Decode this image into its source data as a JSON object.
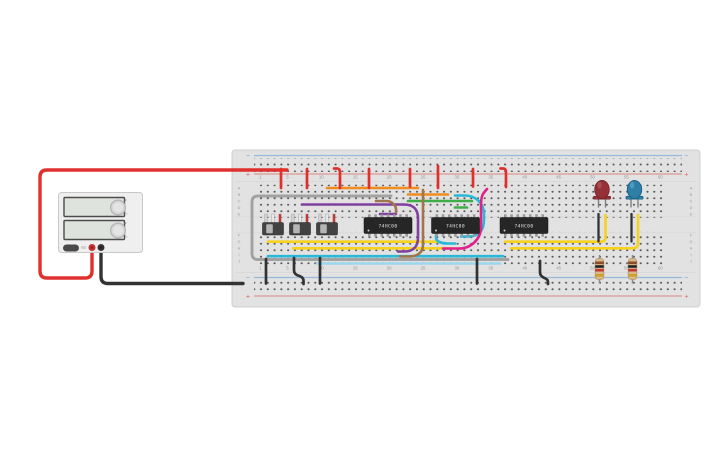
{
  "canvas": {
    "bg": "#ffffff"
  },
  "board": {
    "x": 232,
    "y": 150,
    "w": 468,
    "h": 157,
    "fill": "#e2e2e2",
    "edge": "#cfcfcf",
    "hole": "#575757",
    "column_labels": [
      "1",
      "5",
      "10",
      "15",
      "20",
      "25",
      "30",
      "35",
      "40",
      "45",
      "50",
      "55",
      "60"
    ],
    "column_numbers": [
      1,
      5,
      10,
      15,
      20,
      25,
      30,
      35,
      40,
      45,
      50,
      55,
      60
    ],
    "row_letters": [
      "A",
      "B",
      "C",
      "D",
      "E",
      "F",
      "G",
      "H",
      "I",
      "J"
    ],
    "rails": {
      "minus": "−",
      "plus": "+",
      "blue": "#5b9bd5",
      "red": "#e05a5a"
    }
  },
  "psu": {
    "x": 58.5,
    "y": 192.5,
    "w": 84,
    "h": 60,
    "body": "#efefef",
    "edge": "#c8c8c8",
    "display_fill": "#dfe3dd",
    "display_edge": "#4c4c4c",
    "knob_fill": "#d7d7d7",
    "knob_edge": "#b3b3b3",
    "button_fill": "#4a4a4a",
    "terminals": [
      {
        "name": "positive-terminal",
        "cx": 92,
        "cy": 247.5,
        "color": "#d32f2f"
      },
      {
        "name": "negative-terminal",
        "cx": 101,
        "cy": 247.5,
        "color": "#333333"
      }
    ]
  },
  "chips": [
    {
      "label": "74HC00",
      "x": 364,
      "y": 217.5,
      "w": 48,
      "h": 16
    },
    {
      "label": "74HC00",
      "x": 431.5,
      "y": 217.5,
      "w": 48,
      "h": 16
    },
    {
      "label": "74HC00",
      "x": 500,
      "y": 217.5,
      "w": 48,
      "h": 16
    }
  ],
  "switches": [
    {
      "cx": 273
    },
    {
      "cx": 300
    },
    {
      "cx": 327
    }
  ],
  "leds": [
    {
      "name": "led-red",
      "cx": 602,
      "body": "#973138",
      "dark": "#6f2228",
      "light": "#b2555c"
    },
    {
      "name": "led-blue",
      "cx": 634.5,
      "body": "#2d7fa7",
      "dark": "#1f5f80",
      "light": "#5ba4c4"
    }
  ],
  "resistors": [
    {
      "cx": 599.5,
      "bands": [
        "#8a4b2a",
        "#242424",
        "#c03a3a",
        "#c9a227"
      ]
    },
    {
      "cx": 632.5,
      "bands": [
        "#8a4b2a",
        "#242424",
        "#c03a3a",
        "#c9a227"
      ]
    }
  ],
  "wires": [
    {
      "name": "cyan-bus-row-i",
      "color": "#29b8d8",
      "w": 2.6,
      "r": 5,
      "pts": [
        [
          268,
          256.2
        ],
        [
          503,
          256.2
        ]
      ]
    },
    {
      "name": "lightblue-bus-row-j",
      "color": "#9bd7ee",
      "w": 2.6,
      "r": 5,
      "pts": [
        [
          317,
          263.5
        ],
        [
          500,
          263.5
        ]
      ]
    },
    {
      "name": "gray-bus-wire",
      "color": "#a2a2a2",
      "w": 2.9,
      "r": 6,
      "pts": [
        [
          391,
          196
        ],
        [
          252,
          196
        ],
        [
          252,
          259.5
        ],
        [
          508,
          259.5
        ]
      ]
    },
    {
      "name": "yellow-wire-g-left",
      "color": "#f7d21c",
      "w": 2.6,
      "r": 5,
      "pts": [
        [
          268,
          241.7
        ],
        [
          437,
          241.7
        ]
      ]
    },
    {
      "name": "yellow-wire-h-left",
      "color": "#f7d21c",
      "w": 2.6,
      "r": 5,
      "pts": [
        [
          293,
          248.3
        ],
        [
          452,
          248.3
        ]
      ]
    },
    {
      "name": "yellow-wire-g-right",
      "color": "#f7d21c",
      "w": 2.6,
      "r": 5,
      "pts": [
        [
          505,
          241.7
        ],
        [
          605.5,
          241.7
        ],
        [
          605.5,
          215
        ]
      ]
    },
    {
      "name": "yellow-wire-h-right",
      "color": "#f7d21c",
      "w": 2.6,
      "r": 5,
      "pts": [
        [
          511,
          248.3
        ],
        [
          638,
          248.3
        ],
        [
          638,
          215
        ]
      ]
    },
    {
      "name": "orange-wire-row-a",
      "color": "#f08c1d",
      "w": 2.6,
      "r": 5,
      "pts": [
        [
          327,
          188
        ],
        [
          418,
          188
        ]
      ]
    },
    {
      "name": "orange-wire-row-b",
      "color": "#f08c1d",
      "w": 2.6,
      "r": 5,
      "pts": [
        [
          408,
          194.5
        ],
        [
          448,
          194.5
        ]
      ]
    },
    {
      "name": "green-wire-row-c",
      "color": "#3fae49",
      "w": 2.6,
      "r": 5,
      "pts": [
        [
          408,
          201
        ],
        [
          472,
          201
        ]
      ]
    },
    {
      "name": "green-wire-row-d",
      "color": "#3fae49",
      "w": 2.6,
      "r": 5,
      "pts": [
        [
          455,
          207.5
        ],
        [
          467,
          207.5
        ]
      ]
    },
    {
      "name": "purple-wire-loop",
      "color": "#8040a0",
      "w": 2.6,
      "r": 7,
      "pts": [
        [
          302,
          204.5
        ],
        [
          411,
          204.5
        ],
        [
          418,
          211.5
        ],
        [
          418,
          244.5
        ],
        [
          411,
          251.5
        ],
        [
          398,
          251.5
        ]
      ]
    },
    {
      "name": "purple-wire-stub",
      "color": "#8040a0",
      "w": 2.6,
      "r": 4,
      "pts": [
        [
          380,
          214
        ],
        [
          396,
          214
        ]
      ]
    },
    {
      "name": "brown-wire-vertical",
      "color": "#a0744c",
      "w": 2.6,
      "r": 6,
      "pts": [
        [
          423,
          190
        ],
        [
          423,
          250.5
        ],
        [
          415.5,
          256.5
        ],
        [
          400,
          256.5
        ]
      ]
    },
    {
      "name": "brown-wire-stub",
      "color": "#a0744c",
      "w": 2.6,
      "r": 4,
      "pts": [
        [
          376,
          201
        ],
        [
          390.5,
          201
        ],
        [
          396,
          206.5
        ],
        [
          396,
          212
        ]
      ]
    },
    {
      "name": "cyan-hook-chip2",
      "color": "#29b8d8",
      "w": 2.6,
      "r": 5,
      "pts": [
        [
          436,
          235
        ],
        [
          436,
          240.5
        ],
        [
          443,
          243.5
        ],
        [
          455,
          243.5
        ]
      ]
    },
    {
      "name": "cyan-loop-chip2",
      "color": "#29b8d8",
      "w": 2.6,
      "r": 8,
      "pts": [
        [
          455,
          195.5
        ],
        [
          473,
          195.5
        ],
        [
          484,
          206
        ],
        [
          484,
          228
        ],
        [
          476,
          236.5
        ],
        [
          461,
          236.5
        ]
      ]
    },
    {
      "name": "magenta-loop",
      "color": "#e0218a",
      "w": 2.6,
      "r": 9,
      "pts": [
        [
          443,
          248.5
        ],
        [
          468,
          248.5
        ],
        [
          481,
          236
        ],
        [
          481,
          196
        ],
        [
          487,
          189
        ]
      ]
    },
    {
      "name": "red-jumper-1",
      "color": "#e0302e",
      "w": 2.7,
      "r": 4,
      "pts": [
        [
          281,
          169
        ],
        [
          281,
          188
        ]
      ]
    },
    {
      "name": "red-jumper-2",
      "color": "#e0302e",
      "w": 2.7,
      "r": 4,
      "pts": [
        [
          307,
          169
        ],
        [
          307,
          188
        ]
      ]
    },
    {
      "name": "red-jumper-3",
      "color": "#e0302e",
      "w": 2.7,
      "r": 4,
      "pts": [
        [
          334,
          168.5
        ],
        [
          340,
          168.5
        ],
        [
          340,
          188
        ]
      ]
    },
    {
      "name": "red-jumper-4",
      "color": "#e0302e",
      "w": 2.7,
      "r": 4,
      "pts": [
        [
          369,
          169
        ],
        [
          369,
          188
        ]
      ]
    },
    {
      "name": "red-jumper-5",
      "color": "#e0302e",
      "w": 2.7,
      "r": 4,
      "pts": [
        [
          410,
          169
        ],
        [
          410,
          186.5
        ]
      ]
    },
    {
      "name": "red-jumper-6",
      "color": "#e0302e",
      "w": 2.7,
      "r": 4,
      "pts": [
        [
          438,
          166
        ],
        [
          438,
          188
        ]
      ]
    },
    {
      "name": "red-jumper-7",
      "color": "#e0302e",
      "w": 2.7,
      "r": 4,
      "pts": [
        [
          473,
          169
        ],
        [
          473,
          186.5
        ]
      ]
    },
    {
      "name": "red-jumper-8",
      "color": "#e0302e",
      "w": 2.7,
      "r": 4,
      "pts": [
        [
          500.5,
          168.5
        ],
        [
          506,
          168.5
        ],
        [
          506,
          187
        ]
      ]
    },
    {
      "name": "black-jumper-1",
      "color": "#323232",
      "w": 2.7,
      "r": 4,
      "pts": [
        [
          266,
          259
        ],
        [
          266,
          283.5
        ]
      ]
    },
    {
      "name": "black-jumper-2",
      "color": "#323232",
      "w": 2.7,
      "r": 4,
      "pts": [
        [
          294,
          258
        ],
        [
          294,
          274
        ],
        [
          303.5,
          277.5
        ],
        [
          303.5,
          284
        ]
      ]
    },
    {
      "name": "black-jumper-3",
      "color": "#323232",
      "w": 2.7,
      "r": 4,
      "pts": [
        [
          320,
          258
        ],
        [
          320,
          283.5
        ]
      ]
    },
    {
      "name": "black-jumper-4",
      "color": "#323232",
      "w": 2.7,
      "r": 4,
      "pts": [
        [
          477,
          259
        ],
        [
          477,
          283.5
        ]
      ]
    },
    {
      "name": "black-jumper-5",
      "color": "#323232",
      "w": 2.7,
      "r": 4,
      "pts": [
        [
          540,
          261
        ],
        [
          540,
          276
        ],
        [
          548,
          279.5
        ],
        [
          548,
          284
        ]
      ]
    },
    {
      "name": "led1-cathode-jumper",
      "color": "#323232",
      "w": 2.3,
      "r": 4,
      "pts": [
        [
          598.5,
          214
        ],
        [
          598.5,
          241.5
        ]
      ]
    },
    {
      "name": "led2-cathode-jumper",
      "color": "#323232",
      "w": 2.3,
      "r": 4,
      "pts": [
        [
          631.5,
          214
        ],
        [
          631.5,
          241.5
        ]
      ]
    },
    {
      "name": "psu-positive-wire",
      "color": "#e0302e",
      "w": 3.4,
      "r": 7,
      "pts": [
        [
          92,
          249
        ],
        [
          92,
          278
        ],
        [
          40,
          278
        ],
        [
          40,
          170
        ],
        [
          287,
          170
        ]
      ]
    },
    {
      "name": "psu-negative-wire",
      "color": "#333333",
      "w": 3.4,
      "r": 7,
      "pts": [
        [
          101,
          249
        ],
        [
          101,
          283.5
        ],
        [
          243,
          283.5
        ]
      ]
    }
  ]
}
